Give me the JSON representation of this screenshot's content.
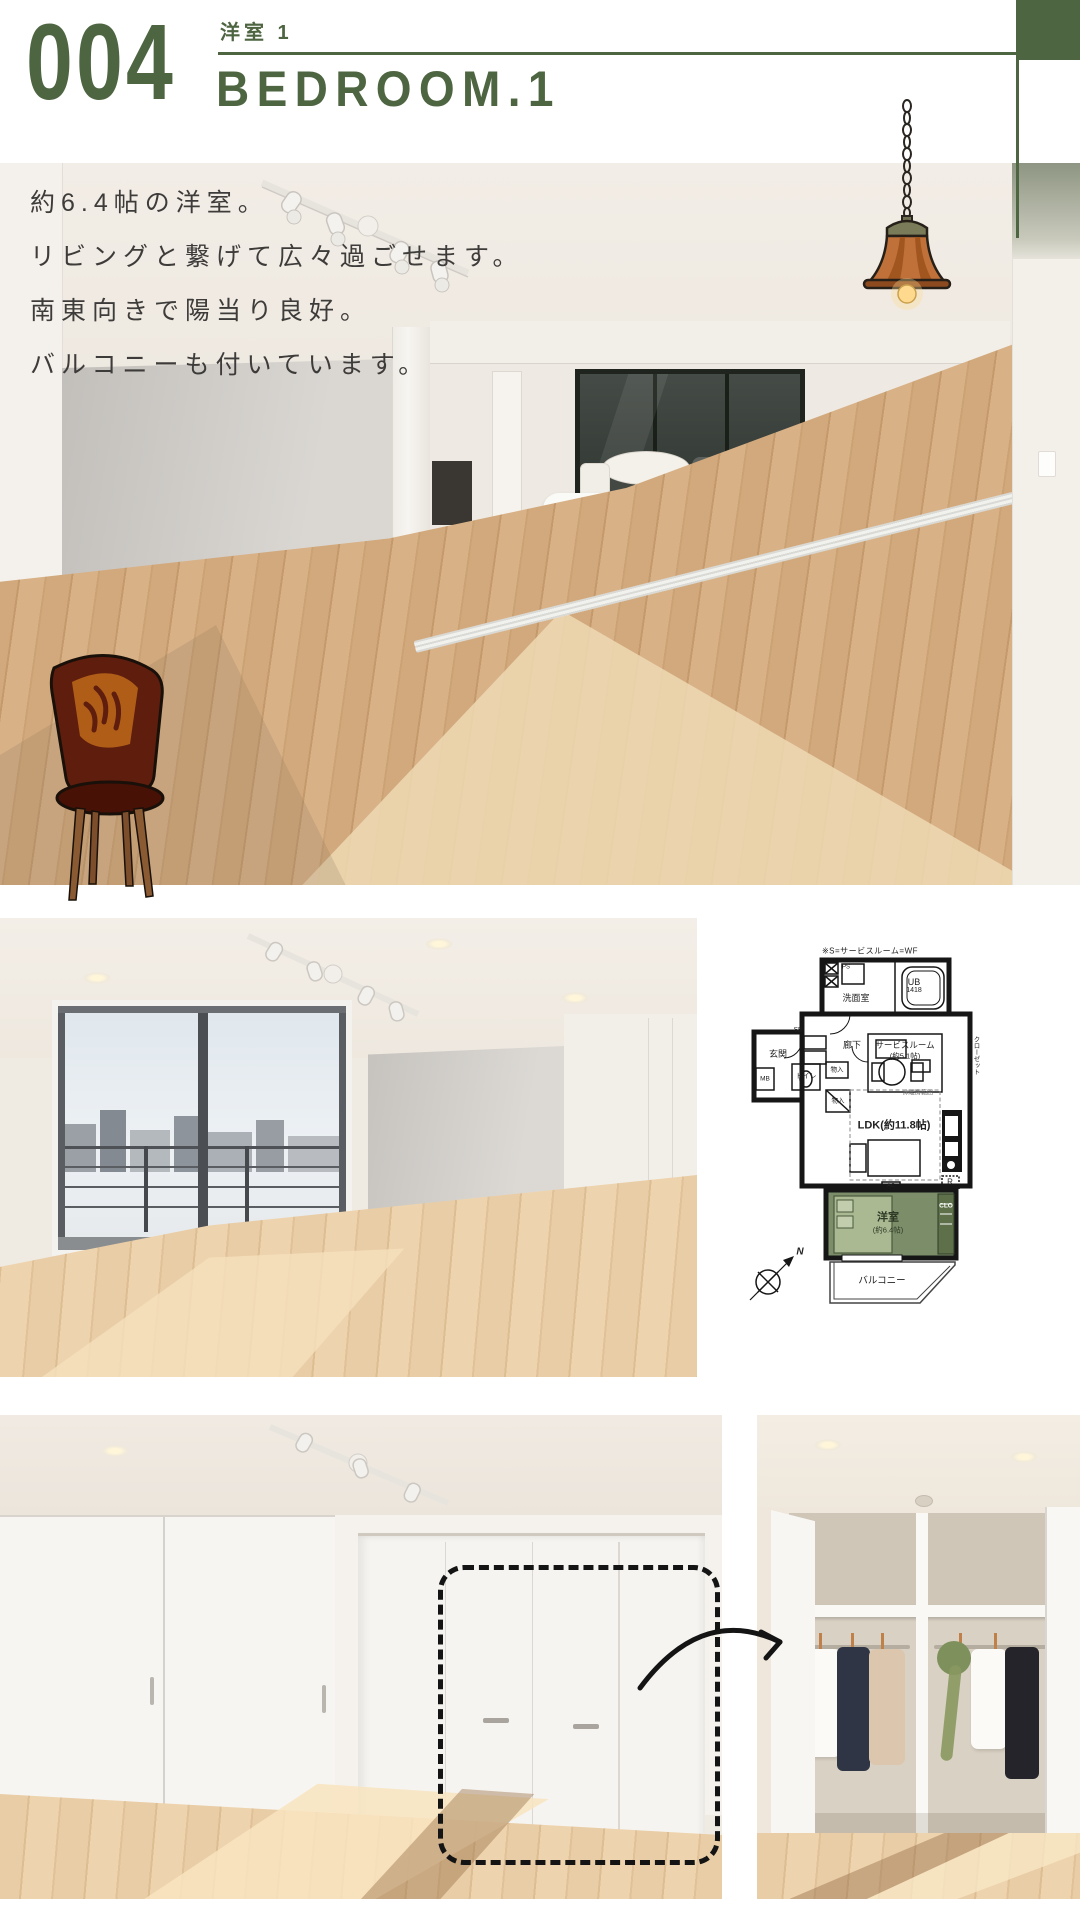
{
  "accent": {
    "green": "#4e6541",
    "plan_room_green": "#7b8d69"
  },
  "header": {
    "number": "004",
    "room_jp": "洋室 1",
    "room_en": "BEDROOM.1"
  },
  "hero": {
    "lines": [
      "約6.4帖の洋室。",
      "リビングと繋げて広々過ごせます。",
      "南東向きで陽当り良好。",
      "バルコニーも付いています。"
    ]
  },
  "floor_plan": {
    "note": "※S=サービスルーム=WF",
    "washroom": "洗面室",
    "ub": "UB",
    "ub_size": "1418",
    "ps": "PS",
    "entrance": "玄関",
    "sb": "SB",
    "hallway": "廊下",
    "service_room": "サービスルーム",
    "service_room_size": "(約5.1帖)",
    "toilet": "トイレ",
    "storage_a": "物入",
    "storage_b": "物入",
    "mb": "MB",
    "ldk": "LDK(約11.8帖)",
    "floor_heating": "床暖房範囲",
    "fridge": "R",
    "ac": "AC",
    "clo": "CLO",
    "closet_vertical": "クローゼット",
    "bedroom": "洋室",
    "bedroom_size": "(約6.4帖)",
    "balcony": "バルコニー",
    "north": "N"
  }
}
